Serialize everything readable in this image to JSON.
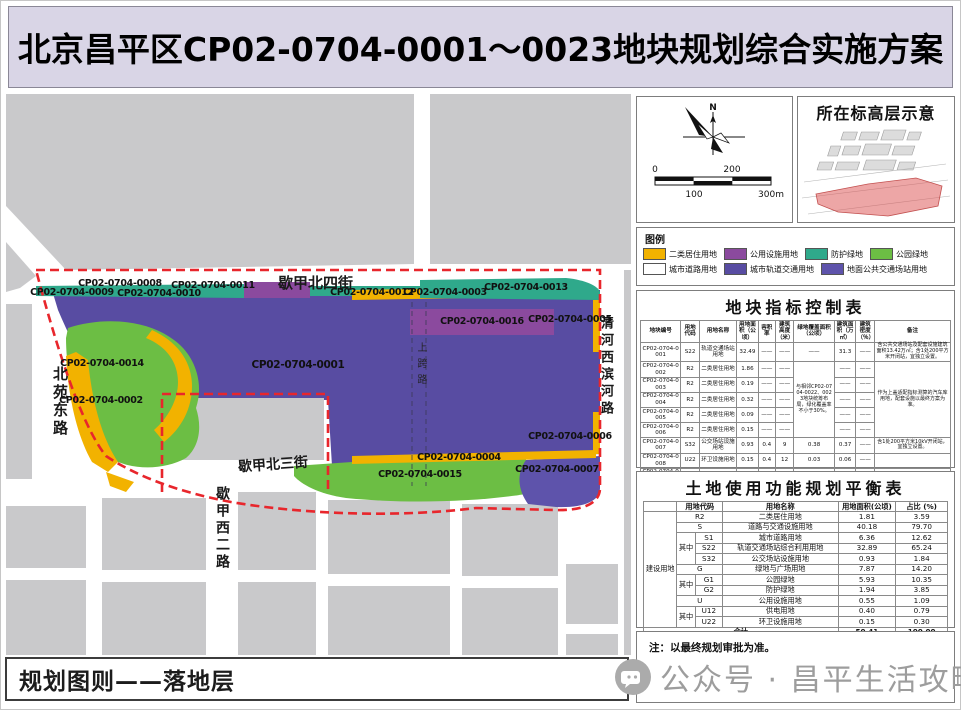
{
  "title": "北京昌平区CP02-0704-0001～0023地块规划综合实施方案",
  "compass": {
    "north": "N",
    "scale": {
      "t0": "0",
      "t100": "100",
      "t200": "200",
      "t300": "300m"
    }
  },
  "elevation": {
    "title": "所在标高层示意"
  },
  "legend": {
    "title": "图例",
    "items": [
      {
        "label": "二类居住用地",
        "color": "#F2B200"
      },
      {
        "label": "公用设施用地",
        "color": "#8B4A9E"
      },
      {
        "label": "防护绿地",
        "color": "#2FA98B"
      },
      {
        "label": "公园绿地",
        "color": "#6CBE44"
      },
      {
        "label": "城市道路用地",
        "color": "#FFFFFF"
      },
      {
        "label": "城市轨道交通用地",
        "color": "#584CA2"
      },
      {
        "label": "地面公共交通场站用地",
        "color": "#5E53AB"
      }
    ]
  },
  "map": {
    "colors": {
      "rail_purple": "#584CA2",
      "transit_purple": "#5E53AB",
      "park_green": "#6CBE44",
      "protect_teal": "#2FA98B",
      "residential_yellow": "#F2B200",
      "utility_magenta": "#8B4A9E",
      "block_gray": "#C9C9CB",
      "boundary_red": "#E8262C"
    },
    "streets": {
      "xiejia_north4": "歇甲北四街",
      "beiyuan_east": "北苑东路",
      "qinghe_west": "清河西滨河路",
      "xiejia_north3": "歇甲北三街",
      "xiejia_west2": "歇甲西二路",
      "shangkua": "上跨路"
    },
    "plots": {
      "p0001": "CP02-0704-0001",
      "p0002": "CP02-0704-0002",
      "p0003": "CP02-0704-0003",
      "p0004": "CP02-0704-0004",
      "p0005": "CP02-0704-0005",
      "p0006": "CP02-0704-0006",
      "p0007": "CP02-0704-0007",
      "p0008": "CP02-0704-0008",
      "p0009": "CP02-0704-0009",
      "p0010": "CP02-0704-0010",
      "p0011": "CP02-0704-0011",
      "p0012": "CP02-0704-0012",
      "p0013": "CP02-0704-0013",
      "p0014": "CP02-0704-0014",
      "p0015": "CP02-0704-0015",
      "p0016": "CP02-0704-0016"
    }
  },
  "control_table": {
    "title": "地块指标控制表",
    "widths": [
      "13%",
      "6%",
      "12%",
      "7%",
      "5.5%",
      "6%",
      "13%",
      "7%",
      "6%",
      "24.5%"
    ],
    "header": [
      [
        "地块编号",
        "用地代码",
        "用地名称",
        "用地面积（公顷）",
        "容积率",
        "建筑高度（米）",
        "绿地覆盖面积（公顷）",
        "建筑面积（万㎡）",
        "建筑密度（％）",
        "备注"
      ]
    ],
    "rows": [
      [
        "CP02-0704-0001",
        "S22",
        "轨道交通场站用地",
        "32.49",
        "——",
        "——",
        "——",
        "31.3",
        "——",
        {
          "t": "含公共交通场站及配套设施建筑面积13.42万㎡；含1处200平方米开闭站，宜独立设置。",
          "cls": "left"
        }
      ],
      [
        "CP02-0704-0002",
        "R2",
        "二类居住用地",
        "1.86",
        "——",
        "——",
        {
          "t": "与相邻CP02-0704-0022、0023地块统筹布局，绿化覆盖率不小于30%。",
          "rs": 5,
          "cls": "left"
        },
        "——",
        "——",
        {
          "t": "作为上盖适配指标测算的汽车库用地，配套设施以最终方案为准。",
          "rs": 5,
          "cls": "left"
        }
      ],
      [
        "CP02-0704-0003",
        "R2",
        "二类居住用地",
        "0.19",
        "——",
        "——",
        "——",
        "——"
      ],
      [
        "CP02-0704-0004",
        "R2",
        "二类居住用地",
        "0.32",
        "——",
        "——",
        "——",
        "——"
      ],
      [
        "CP02-0704-0005",
        "R2",
        "二类居住用地",
        "0.09",
        "——",
        "——",
        "——",
        "——"
      ],
      [
        "CP02-0704-0006",
        "R2",
        "二类居住用地",
        "0.15",
        "——",
        "——",
        "——",
        "——"
      ],
      [
        "CP02-0704-0007",
        "S32",
        "公交场站设施用地",
        "0.93",
        "0.4",
        "9",
        "0.38",
        "0.37",
        "——",
        {
          "t": "含1处200平方米10kV开闭站，宜独立设置。",
          "cls": "left"
        }
      ],
      [
        "CP02-0704-0008",
        "U22",
        "环卫设施用地",
        "0.15",
        "0.4",
        "12",
        "0.03",
        "0.06",
        "——",
        ""
      ],
      [
        "CP02-0704-0009",
        "G2",
        "防护绿地",
        "0.29",
        "——",
        "——",
        "——",
        "——",
        "——",
        ""
      ],
      [
        "CP02-0704-0010",
        "G2",
        "防护绿地",
        "0.73",
        "——",
        "——",
        "——",
        "——",
        "——",
        ""
      ],
      [
        "CP02-0704-0011",
        "G2",
        "防护绿地",
        "0.09",
        "——",
        "——",
        "——",
        "——",
        "——",
        ""
      ],
      [
        "CP02-0704-0012",
        "G2",
        "防护绿地",
        "0.86",
        "——",
        "——",
        "——",
        "——",
        "——",
        ""
      ],
      [
        "CP02-0704-0013",
        "G2",
        "防护绿地",
        "0.78",
        "——",
        "——",
        "——",
        "——",
        "——",
        ""
      ],
      [
        "CP02-0704-0014",
        "G1",
        "公园绿地",
        "3.66",
        "——",
        "——",
        "——",
        "——",
        "——",
        ""
      ],
      [
        "CP02-0704-0015",
        "G1",
        "公园绿地",
        "2.27",
        "——",
        "——",
        "——",
        "——",
        "——",
        {
          "t": "公园绿地设下沉广场和出入口，与上盖平台绿地衔接统筹设计，景观风貌相协调。",
          "cls": "left"
        }
      ],
      [
        "CP02-0704-0016",
        "U12",
        "供电用地",
        "0.40",
        "0.5",
        "12",
        "——",
        "0.16",
        "——",
        {
          "t": "预留110kV变电站。",
          "cls": "left"
        }
      ],
      [
        "——",
        "S1",
        "城市道路用地",
        "6.36",
        "——",
        "——",
        "——",
        "——",
        "——",
        ""
      ],
      [
        {
          "t": "合计",
          "cs": 3,
          "b": 1
        },
        {
          "t": "50.41",
          "b": 1
        },
        "——",
        "——",
        "——",
        {
          "t": "31.79",
          "b": 1
        },
        "——",
        ""
      ]
    ]
  },
  "balance_table": {
    "title": "土地使用功能规划平衡表",
    "widths": [
      "11%",
      "6%",
      "9%",
      "38%",
      "19%",
      "17%"
    ],
    "header": [
      [
        {
          "t": ""
        },
        {
          "t": "用地代码",
          "cs": 2
        },
        "用地名称",
        "用地面积(公顷)",
        "占比 (%)"
      ]
    ],
    "rows": [
      [
        {
          "t": "建设用地",
          "rs": 11
        },
        {
          "t": "R2",
          "cs": 2
        },
        "二类居住用地",
        "1.81",
        "3.59"
      ],
      [
        {
          "t": "S",
          "cs": 2
        },
        "道路与交通设施用地",
        "40.18",
        "79.70"
      ],
      [
        {
          "t": "其中",
          "rs": 3
        },
        "S1",
        "城市道路用地",
        "6.36",
        "12.62"
      ],
      [
        "S22",
        "轨道交通场站综合利用用地",
        "32.89",
        "65.24"
      ],
      [
        "S32",
        "公交场站设施用地",
        "0.93",
        "1.84"
      ],
      [
        {
          "t": "G",
          "cs": 2
        },
        "绿地与广场用地",
        "7.87",
        "14.20"
      ],
      [
        {
          "t": "其中",
          "rs": 2
        },
        "G1",
        "公园绿地",
        "5.93",
        "10.35"
      ],
      [
        "G2",
        "防护绿地",
        "1.94",
        "3.85"
      ],
      [
        {
          "t": "U",
          "cs": 2
        },
        "公用设施用地",
        "0.55",
        "1.09"
      ],
      [
        {
          "t": "其中",
          "rs": 2
        },
        "U12",
        "供电用地",
        "0.40",
        "0.79"
      ],
      [
        "U22",
        "环卫设施用地",
        "0.15",
        "0.30"
      ],
      [
        {
          "t": "合计",
          "cs": 4,
          "b": 1
        },
        {
          "t": "50.41",
          "b": 1
        },
        {
          "t": "100.00",
          "b": 1
        }
      ]
    ]
  },
  "note": "注：以最终规划审批为准。",
  "footer": {
    "label": "规划图则——落地层"
  },
  "watermark": {
    "text": "公众号 · 昌平生活攻略"
  }
}
